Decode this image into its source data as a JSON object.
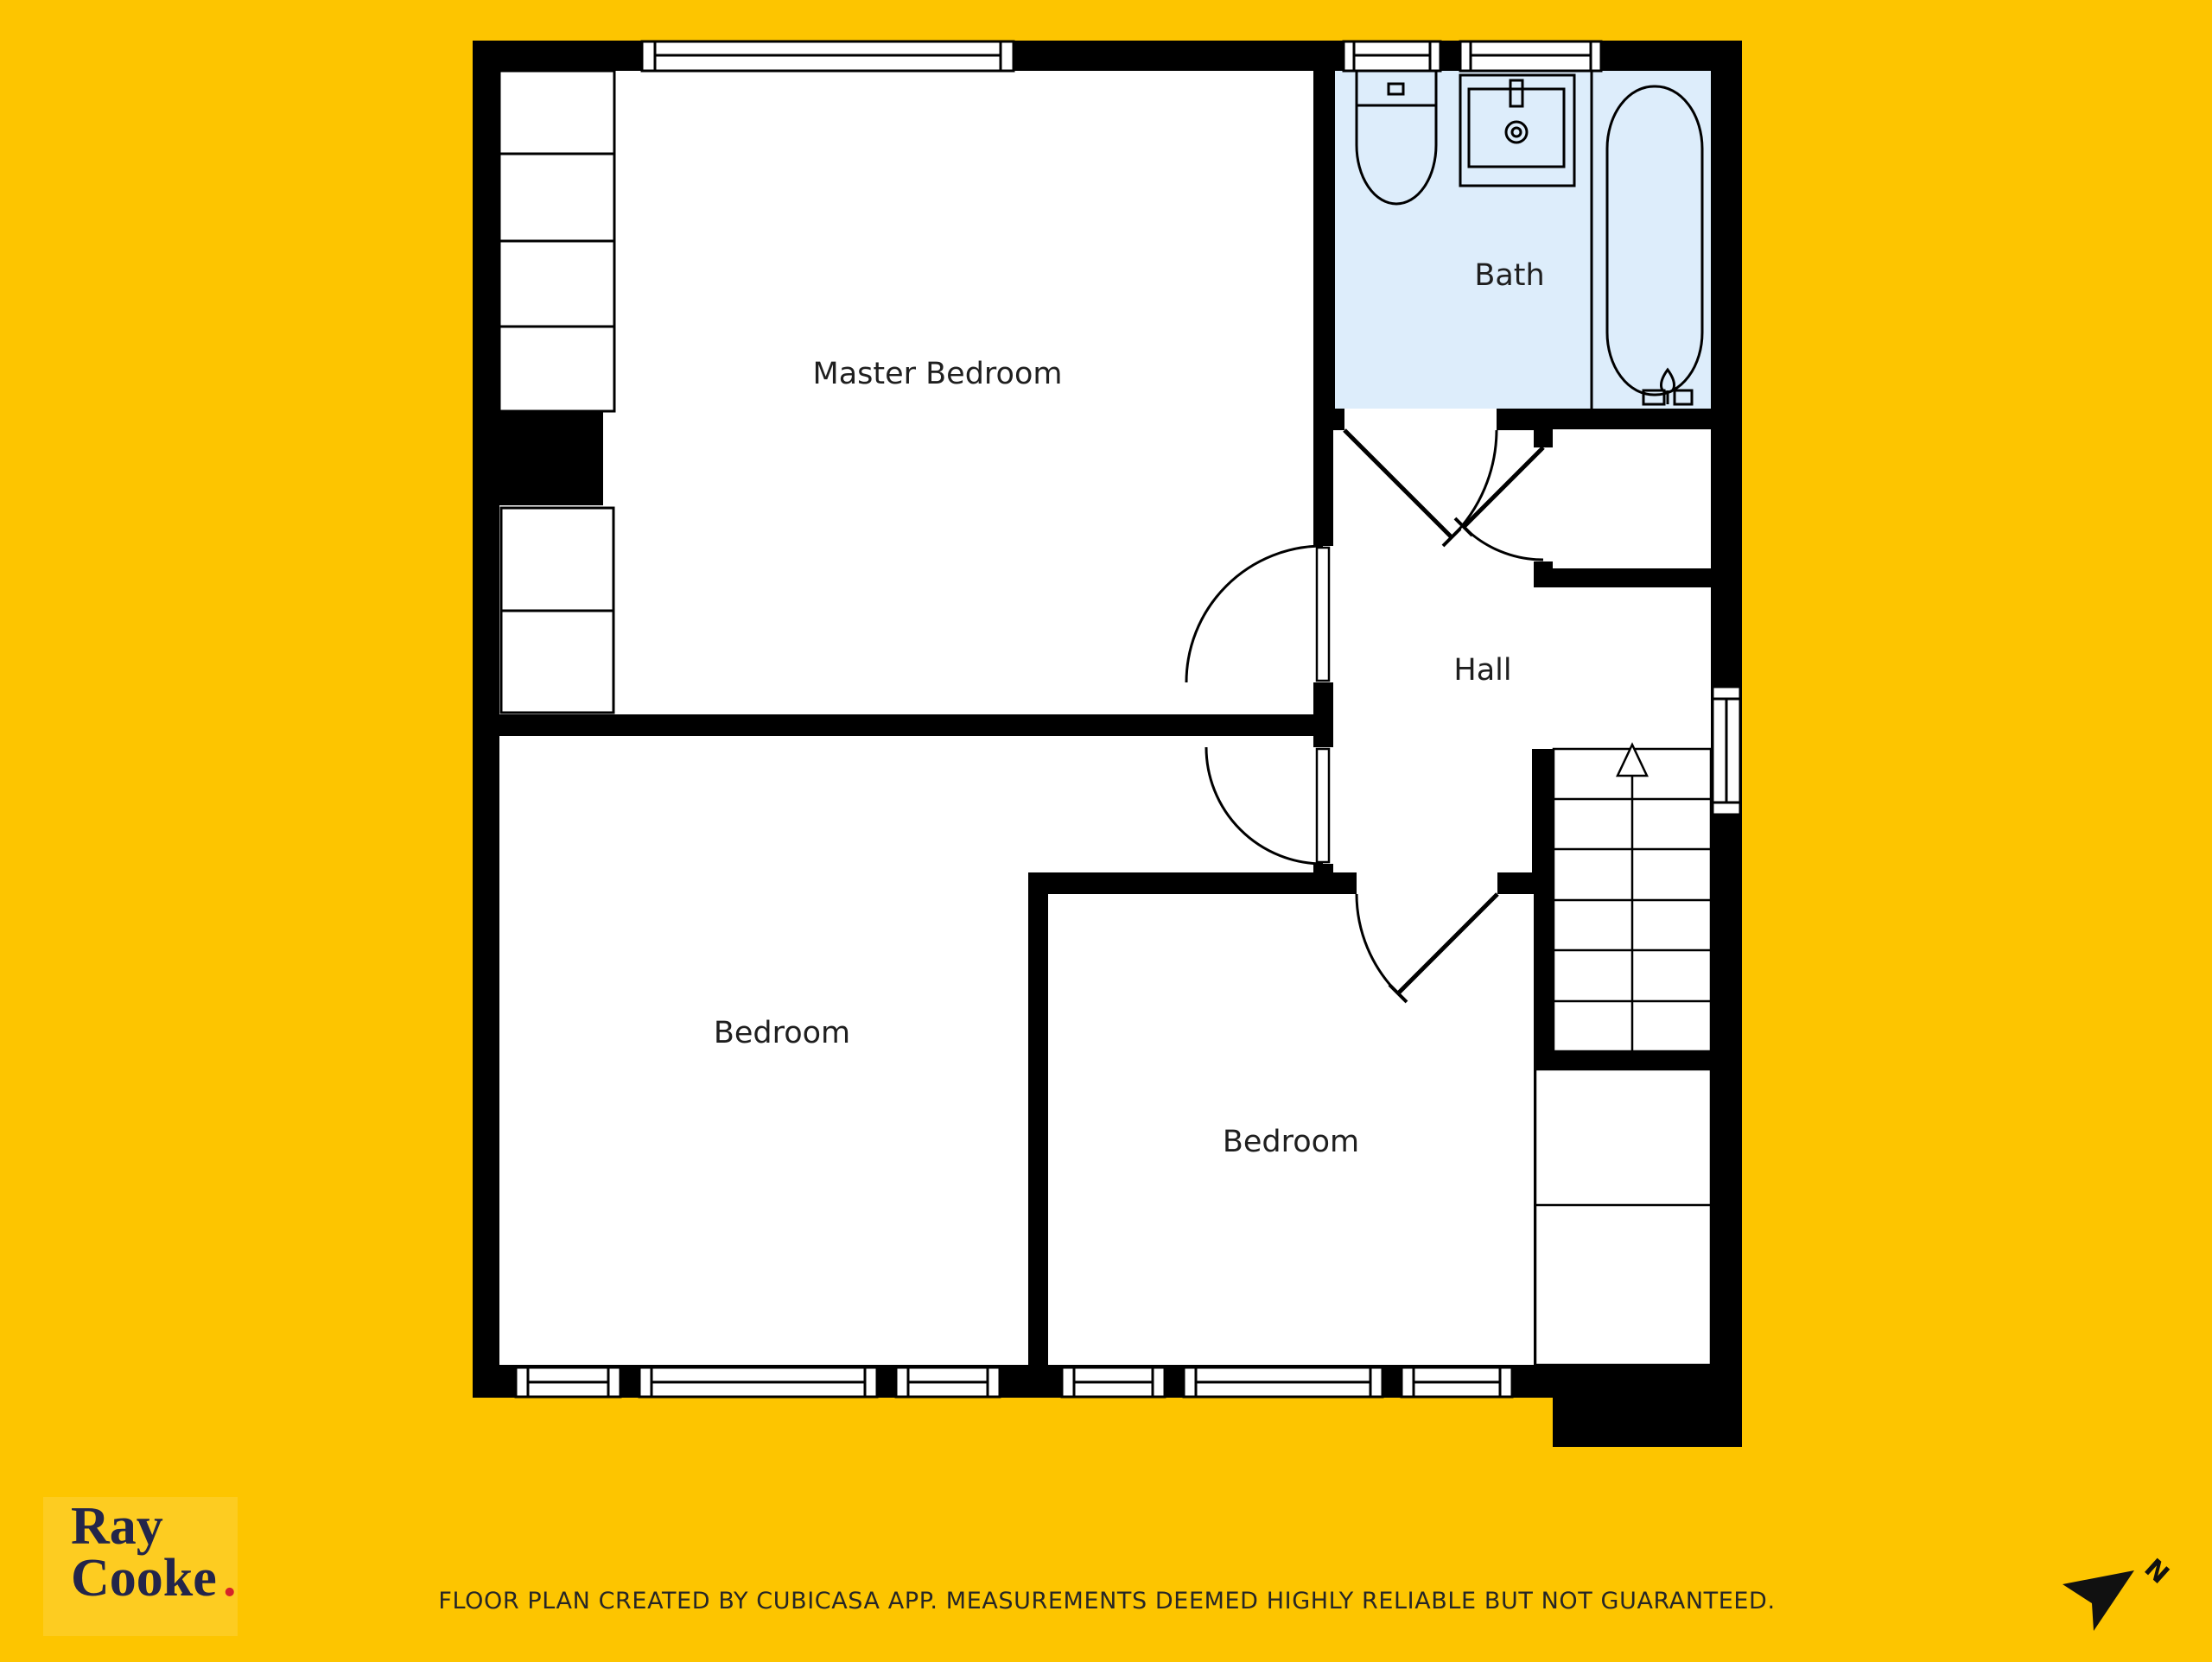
{
  "colors": {
    "background": "#fdc500",
    "wall": "#000000",
    "room_floor": "#ffffff",
    "bath_floor": "#ddedfb",
    "line": "#000000",
    "logo_navy": "#23254a",
    "logo_dot_red": "#d5232a",
    "label_text": "#1f1f1f",
    "footer_text": "#262626"
  },
  "rooms": {
    "master_bedroom": {
      "label": "Master Bedroom"
    },
    "bath": {
      "label": "Bath"
    },
    "hall": {
      "label": "Hall"
    },
    "bedroom_left": {
      "label": "Bedroom"
    },
    "bedroom_right": {
      "label": "Bedroom"
    }
  },
  "icons": {
    "toilet": "toilet-icon",
    "sink": "sink-icon",
    "bathtub": "bathtub-icon",
    "stairs": "stairs-up-icon",
    "north_arrow": "north-arrow-icon"
  },
  "branding": {
    "logo_line1": "Ray",
    "logo_line2": "Cooke",
    "logo_dot": ".",
    "north_label": "N"
  },
  "footer": {
    "disclaimer": "FLOOR PLAN CREATED BY CUBICASA APP. MEASUREMENTS DEEMED HIGHLY RELIABLE BUT NOT GUARANTEED."
  }
}
